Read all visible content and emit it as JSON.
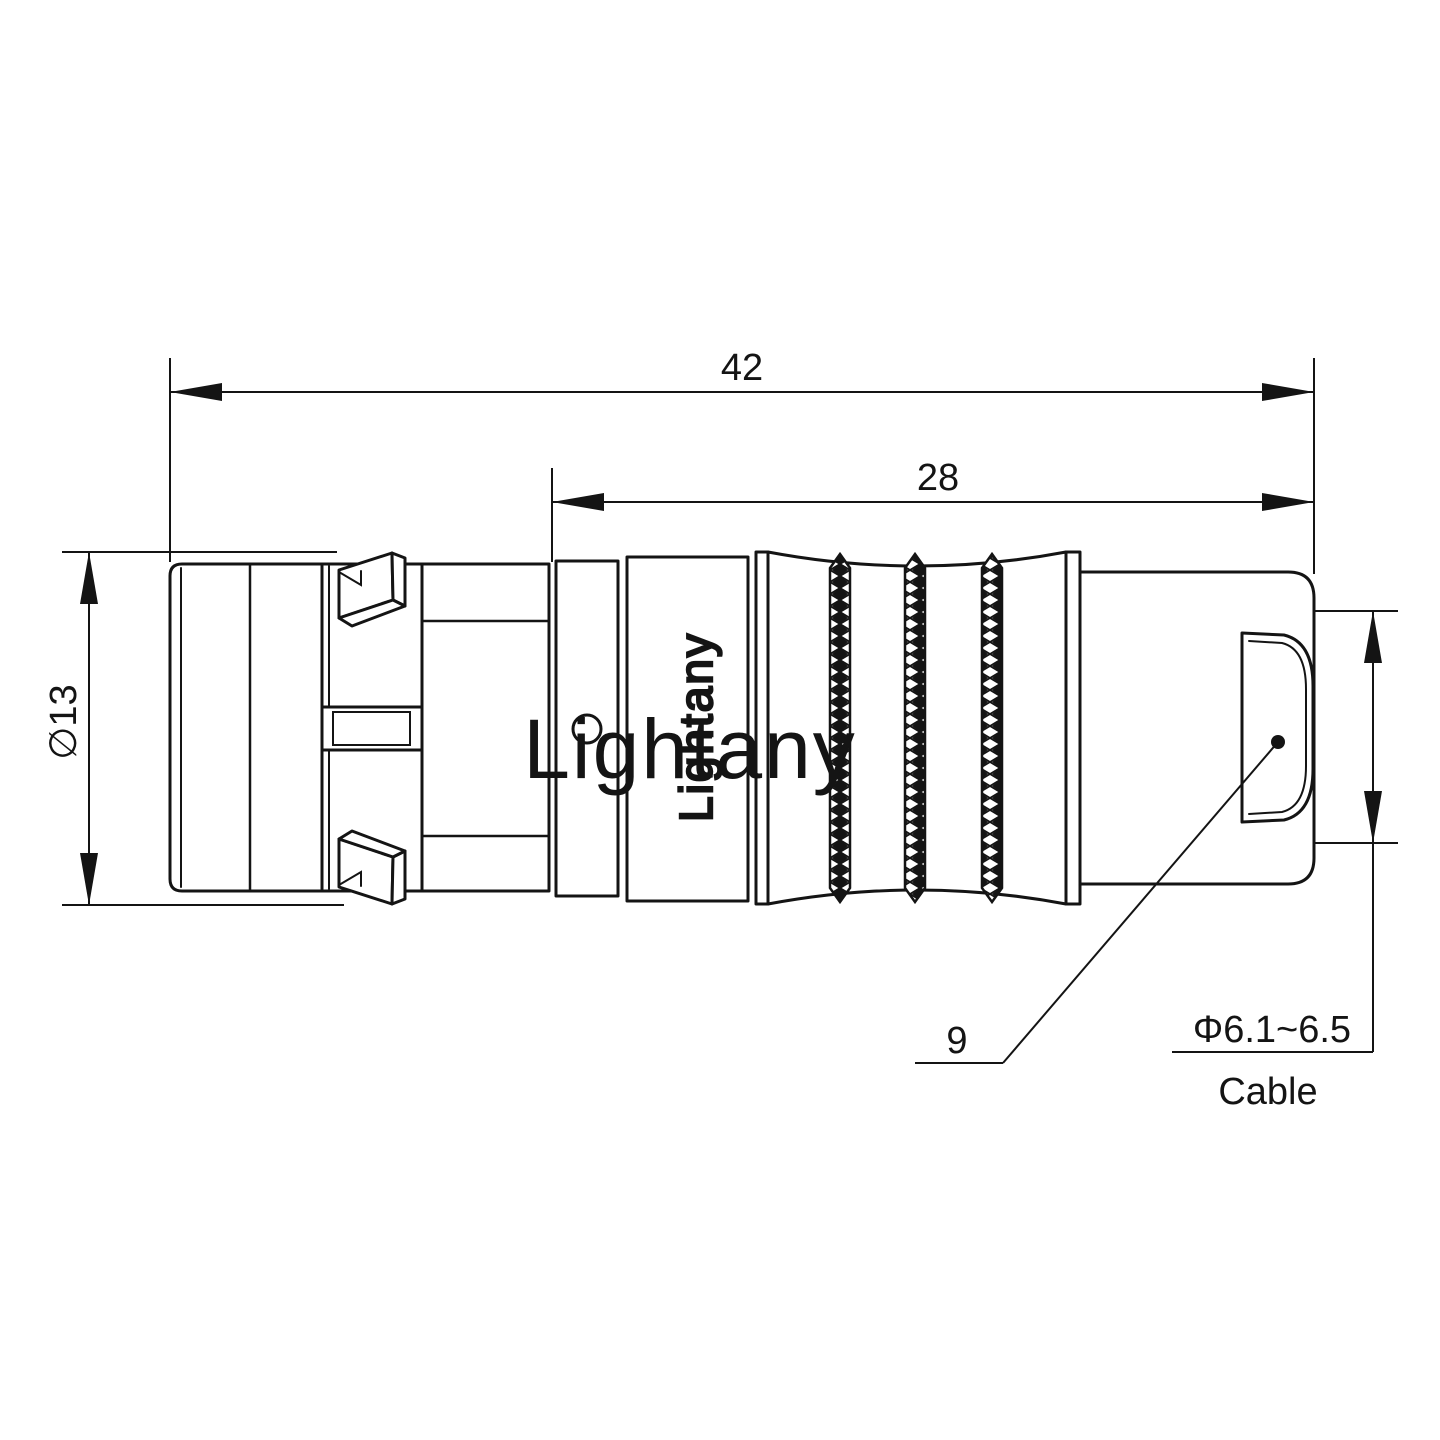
{
  "page": {
    "background": "#ffffff"
  },
  "watermark": {
    "text": "Lightany",
    "color": "rgba(214,105,110,0.38)"
  },
  "connector": {
    "engraving_text": "Lightany"
  },
  "dimensions": {
    "overall_length": "42",
    "rear_section_length": "28",
    "shell_diameter": "∅13",
    "shell_size_ref": "9",
    "cable_diameter_range": "Φ6.1~6.5",
    "cable_label": "Cable"
  },
  "colors": {
    "line": "#141414"
  }
}
